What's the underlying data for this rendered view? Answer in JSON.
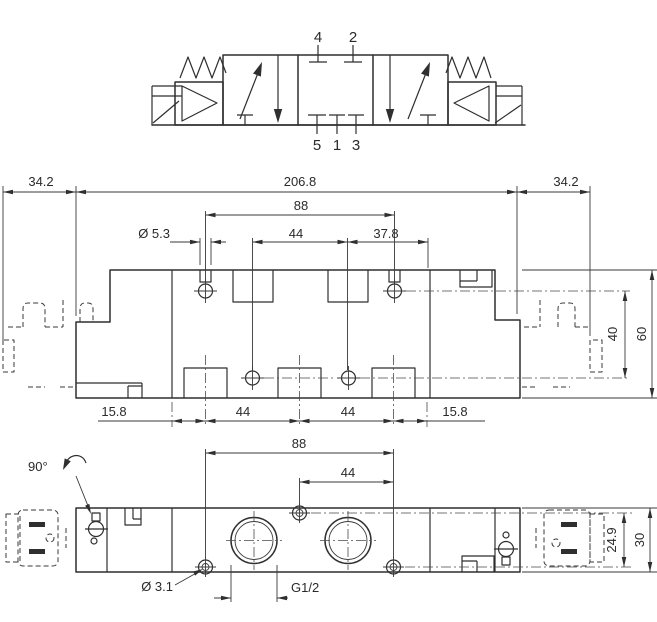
{
  "drawing": {
    "background_color": "#ffffff",
    "line_color": "#2f2f2f",
    "schematic": {
      "ports_top": [
        "4",
        "2"
      ],
      "ports_bottom": [
        "5",
        "1",
        "3"
      ]
    },
    "side_view": {
      "offset_left": "34.2",
      "body_length": "206.8",
      "offset_right": "34.2",
      "mounting_hole_span": "88",
      "mounting_hole_dia": "Ø 5.3",
      "port_pitch_top": "44",
      "pilot_offset": "37.8",
      "hole_rows_span": "40",
      "body_height": "60",
      "edge_to_port_left": "15.8",
      "port_pitch_1": "44",
      "port_pitch_2": "44",
      "edge_to_port_right": "15.8"
    },
    "bottom_view": {
      "mounting_hole_span": "88",
      "hole_to_port": "44",
      "rotation_label": "90°",
      "small_hole_dia": "Ø 3.1",
      "thread_label": "G1/2",
      "hole_row_offset": "24.9",
      "body_depth": "30"
    }
  }
}
